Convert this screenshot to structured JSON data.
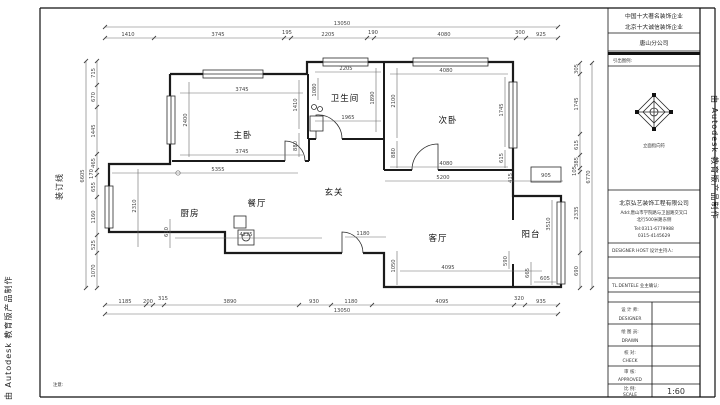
{
  "stamps": {
    "autodesk": "由 Autodesk 教育版产品制作",
    "binding": "装订线",
    "note": "注意:"
  },
  "rooms": {
    "master": "主卧",
    "bath": "卫生间",
    "bed2": "次卧",
    "hall": "玄关",
    "dining": "餐厅",
    "kitchen": "厨房",
    "living": "客厅",
    "balcony": "阳台"
  },
  "dims": {
    "top_total": "13050",
    "bottom_total": "13050",
    "left_total": "6605",
    "right_total": "6770",
    "top": [
      "1410",
      "3745",
      "195",
      "2205",
      "190",
      "4080",
      "300",
      "925"
    ],
    "bottom": [
      "1185",
      "200",
      "315",
      "3890",
      "930",
      "1180",
      "4095",
      "320",
      "935"
    ],
    "left": [
      "715",
      "670",
      "1445",
      "465",
      "170",
      "655",
      "1160",
      "525",
      "1070"
    ],
    "right": [
      "305",
      "1745",
      "615",
      "385",
      "105",
      "2335",
      "690"
    ],
    "interior": {
      "master_top": "3745",
      "master_bottom": "3745",
      "master_left": "2400",
      "master_right": "1410",
      "master_right_lower": "880",
      "bath_top": "2205",
      "bath_left": "1080",
      "bath_right": "1890",
      "bath_bottom": "1965",
      "bed2_top": "4080",
      "bed2_bottom": "4080",
      "bed2_left": "2100",
      "bed2_left_lower": "880",
      "bed2_right": "1745",
      "bed2_right_lower": "615",
      "below_bed2": "5200",
      "notch": "415",
      "shaft": "905",
      "hall_width": "5355",
      "kitchen_height": "2310",
      "kitchen_door": "610",
      "dining_width": "4225",
      "hall_depth": "1180",
      "living_left": "1050",
      "living_bottom": "4095",
      "living_right": "590",
      "balcony_height": "3510",
      "balcony_left": "665",
      "balcony_bottom": "605"
    }
  },
  "titleblock": {
    "honor1": "中国十大著名装饰企业",
    "honor2": "北京十大诚信装饰企业",
    "branch": "唐山分公司",
    "legend_label": "引出图例:",
    "compass_caption": "立面指向符",
    "company": "北京弘艺装饰工程有限公司",
    "address1": "Add:唐山市学院路与卫国路交叉口",
    "address2": "北行500米路东侧",
    "tel1": "Tel:0311-6779988",
    "tel2": "0315-4145629",
    "designer_host": "DESIGNER HOST    设计主持人:",
    "client_confirm": "TL.DENTELE    业主确认:",
    "rows": [
      {
        "zh": "设 计 师:",
        "en": "DESIGNER",
        "value": ""
      },
      {
        "zh": "绘 图 员:",
        "en": "DRAWN",
        "value": ""
      },
      {
        "zh": "校   对:",
        "en": "CHECK",
        "value": ""
      },
      {
        "zh": "审   核:",
        "en": "APPROVED",
        "value": ""
      },
      {
        "zh": "比   例:",
        "en": "SCALE",
        "value": "1:60"
      }
    ]
  }
}
